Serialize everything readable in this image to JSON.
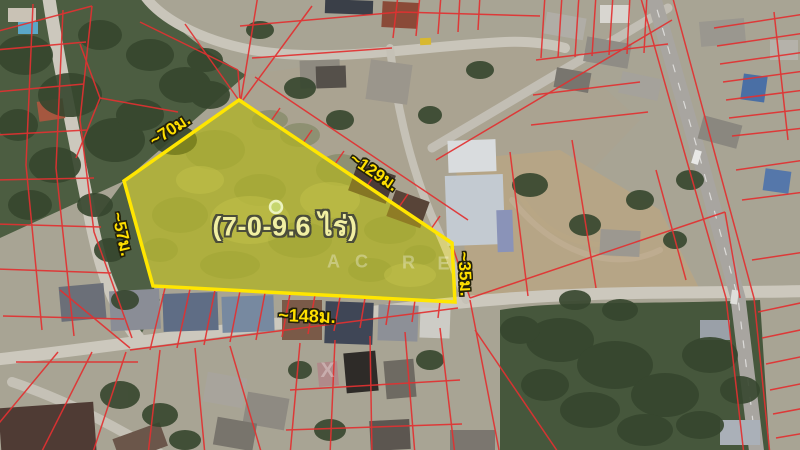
{
  "listing_map": {
    "area_label": "(7-0-9.6 ไร่)",
    "side_measurements": {
      "north_west": "~70ม.",
      "north_east": "~129ม.",
      "west": "~57ม.",
      "south": "~148ม.",
      "east": "~35ม."
    },
    "watermark": {
      "letters": [
        "A",
        "C",
        "R",
        "E"
      ],
      "extra_letter": "X"
    },
    "colors": {
      "plot_outline": "#ffe600",
      "plot_fill": "rgba(255,240,0,0.33)",
      "cadastral_lines": "#e23131",
      "measurement_text": "#ffdf00",
      "area_label_text": "#f1efa2",
      "marker_dot": "#c6d66e"
    }
  }
}
